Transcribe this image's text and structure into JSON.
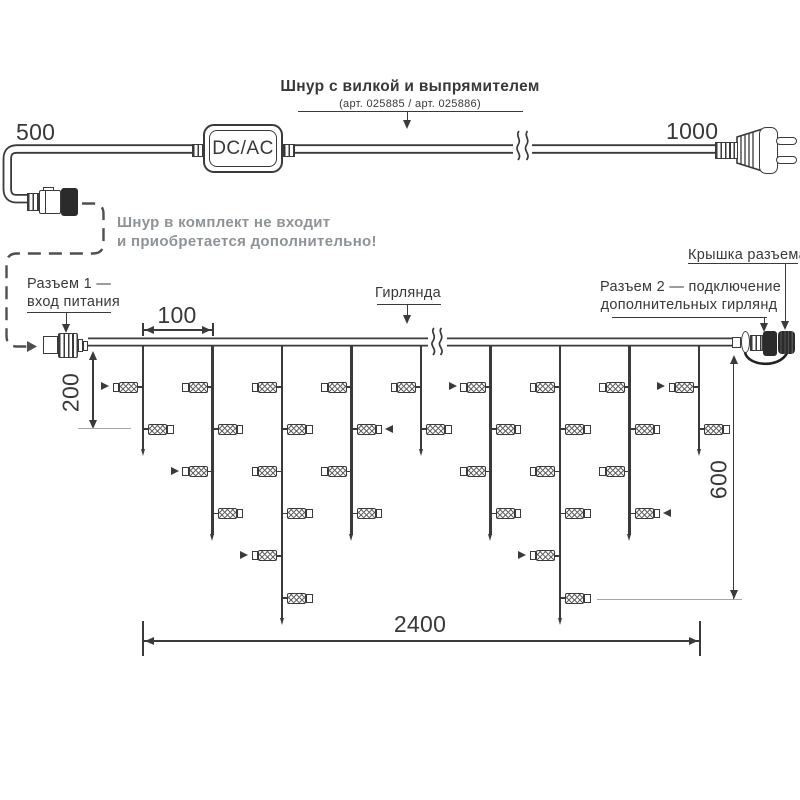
{
  "colors": {
    "ink": "#383838",
    "line": "#3a3a3a",
    "note_gray": "#8e9397"
  },
  "cord": {
    "length_left": "500",
    "length_right": "1000",
    "converter": "DC/AC",
    "title": "Шнур с вилкой и выпрямителем",
    "subtitle": "(арт. 025885 / арт. 025886)",
    "note1": "Шнур в комплект не входит",
    "note2": "и приобретается дополнительно!"
  },
  "labels": {
    "connector1": [
      "Разъем 1 —",
      "вход питания"
    ],
    "garland": "Гирлянда",
    "connector2": [
      "Разъем 2 — подключение",
      "дополнительных гирлянд"
    ],
    "cap": "Крышка разъема"
  },
  "dimensions": {
    "drop_spacing": "100",
    "first_drop": "200",
    "height": "600",
    "length": "2400"
  },
  "garland": {
    "drops": [
      {
        "lamps": 2,
        "markers": [
          1
        ]
      },
      {
        "lamps": 4,
        "markers": [
          3
        ]
      },
      {
        "lamps": 6,
        "markers": [
          5
        ]
      },
      {
        "lamps": 4,
        "markers": [
          2
        ]
      },
      {
        "lamps": 2,
        "markers": []
      },
      {
        "lamps": 4,
        "markers": [
          1
        ]
      },
      {
        "lamps": 6,
        "markers": [
          5
        ]
      },
      {
        "lamps": 4,
        "markers": [
          4
        ]
      },
      {
        "lamps": 2,
        "markers": [
          1
        ]
      }
    ]
  }
}
